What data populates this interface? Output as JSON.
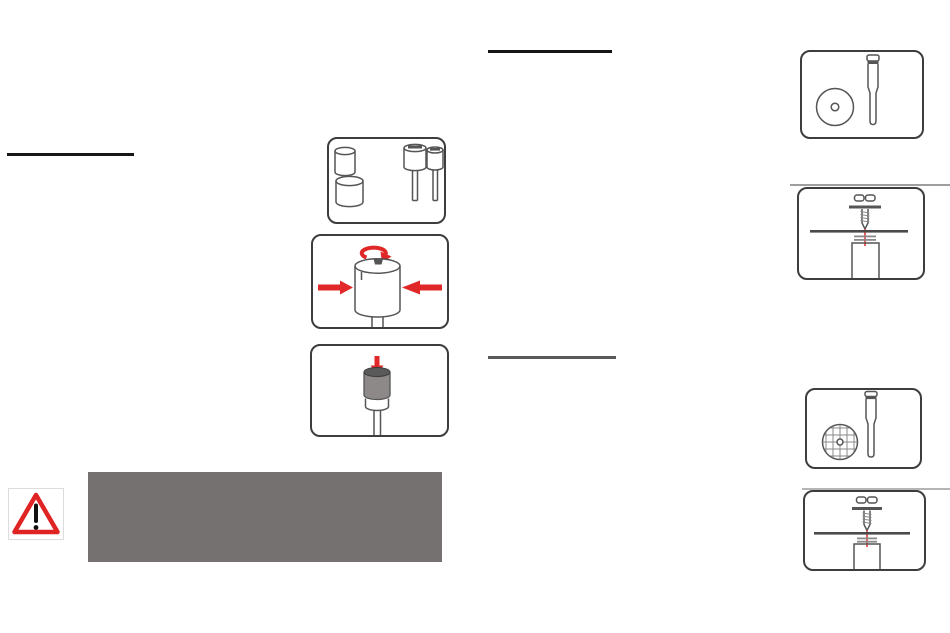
{
  "colors": {
    "accent_red": "#e02828",
    "warning_red": "#e02323",
    "outline_dark": "#3d3d3d",
    "outline_mid": "#555555",
    "outline_light": "#8a8a8a",
    "panel_gray": "#757170",
    "underline_black": "#161616",
    "underline_gray": "#5a5a5a",
    "divider_gray": "#9e9e9e",
    "divider_gray_light": "#b5b5b5",
    "sleeve_gray": "#8d8989",
    "sleeve_top_gray": "#5a5a5a",
    "disc_edge_gray": "#4a4a4a"
  },
  "icons": {
    "warning": "warning-triangle-icon"
  },
  "figures": [
    {
      "name": "sanding-drum-sleeves-and-mandrels"
    },
    {
      "name": "hold-drum-and-turn-top-screw"
    },
    {
      "name": "press-sleeve-onto-mandrel"
    },
    {
      "name": "sanding-disc-and-mandrel"
    },
    {
      "name": "screw-fastens-disc-to-mandrel"
    },
    {
      "name": "mesh-disc-and-mandrel"
    },
    {
      "name": "screw-fastens-mesh-disc-to-mandrel"
    }
  ]
}
